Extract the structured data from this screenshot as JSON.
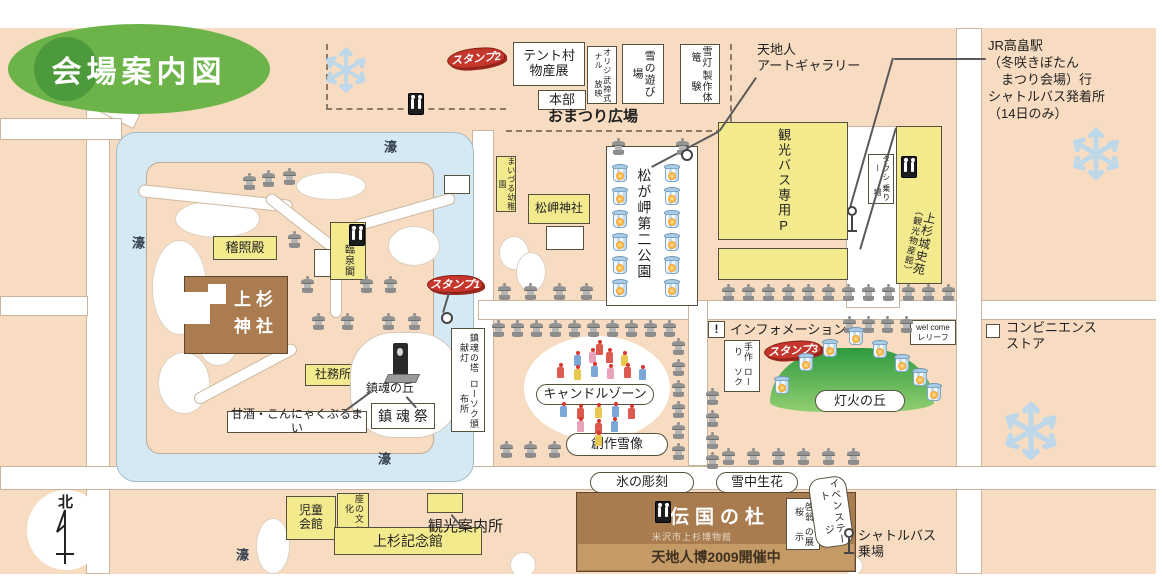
{
  "title": "会場案内図",
  "plaza": {
    "stamp2": "スタンプ2",
    "tent": [
      "テント村",
      "物産展"
    ],
    "honbu": "本部",
    "buteishiki": [
      "オリジナル",
      "武禘式放映"
    ],
    "snow_play": "雪の遊び場",
    "workshop": [
      "雪灯篭",
      "製作体験"
    ],
    "name": "おまつり広場"
  },
  "north_area": {
    "gallery": [
      "天地人",
      "アートギャラリー"
    ],
    "jr": [
      "JR高畠駅",
      "（冬咲きぼたん",
      "　まつり会場）行",
      "シャトルバス発着所",
      "（14日のみ）"
    ]
  },
  "east": {
    "bus_p": "観光バス専用P",
    "taxi": [
      "タクシー",
      "乗り場"
    ],
    "joshien": [
      "上杉城史苑",
      "（観光物産館）"
    ],
    "convenience": [
      "コンビニエンス",
      "ストア"
    ]
  },
  "park": {
    "kindergarten": "まいづる幼稚園",
    "shrine": "松岬神社",
    "name": "松が岬第二公園"
  },
  "island": {
    "keishoden": "稽照殿",
    "rinsenkaku": "臨泉閣",
    "uesugi": [
      "上杉",
      "神社"
    ],
    "shamusho": "社務所",
    "stamp1": "スタンプ1",
    "chinkon_hill": "鎮魂の丘",
    "chinkon_sai": "鎮 魂 祭",
    "amazake": "甘酒・こんにゃくぶるまい",
    "tower": [
      "鎮魂の塔 献灯",
      "ローソク頒布所"
    ]
  },
  "moat_label": "濠",
  "candle": {
    "zone": "キャンドルゾーン",
    "snow_art": "創作雪像"
  },
  "info": {
    "bang": "!",
    "label": "インフォメーション",
    "handmade": [
      "手作り",
      "ローソク"
    ],
    "stamp3": "スタンプ3",
    "hill": "灯火の丘",
    "welcome": [
      "wel come",
      "レリーフ"
    ]
  },
  "south": {
    "jido": [
      "児童",
      "会館"
    ],
    "za": [
      "座の文化",
      "伝承館"
    ],
    "kinenkan": "上杉記念館",
    "annai": "観光案内所",
    "ice": "氷の彫刻",
    "snow_flower": "雪中生花",
    "denkoku": "伝国の杜",
    "museum": "米沢市上杉博物館",
    "expo": "天地人博2009開催中",
    "sakura": [
      "啓翁桜",
      "の展示"
    ],
    "stage": [
      "イベント",
      "ステージ"
    ],
    "shuttle": [
      "シャトルバス",
      "乗場"
    ],
    "north": "北"
  },
  "colors": {
    "background": "#f7dcc2",
    "moat_blue": "#d5e9f5",
    "building_yellow": "#f3ea8e",
    "building_brown": "#ab7c50",
    "title_green": "#6cb44a",
    "stamp_red": "#c5362c",
    "hill_green": "#3f9f46",
    "snowflake_blue": "#b8d8ee"
  },
  "map_icons": {
    "stone_lanterns": [
      [
        243,
        173
      ],
      [
        262,
        170
      ],
      [
        283,
        168
      ],
      [
        288,
        231
      ],
      [
        301,
        276
      ],
      [
        360,
        276
      ],
      [
        384,
        276
      ],
      [
        312,
        313
      ],
      [
        341,
        313
      ],
      [
        382,
        313
      ],
      [
        408,
        313
      ],
      [
        612,
        138
      ],
      [
        676,
        138
      ],
      [
        498,
        283
      ],
      [
        524,
        283
      ],
      [
        553,
        283
      ],
      [
        580,
        283
      ],
      [
        722,
        284
      ],
      [
        742,
        284
      ],
      [
        762,
        284
      ],
      [
        782,
        284
      ],
      [
        802,
        284
      ],
      [
        822,
        284
      ],
      [
        842,
        284
      ],
      [
        862,
        284
      ],
      [
        882,
        284
      ],
      [
        902,
        284
      ],
      [
        922,
        284
      ],
      [
        942,
        284
      ],
      [
        492,
        320
      ],
      [
        511,
        320
      ],
      [
        530,
        320
      ],
      [
        549,
        320
      ],
      [
        568,
        320
      ],
      [
        587,
        320
      ],
      [
        606,
        320
      ],
      [
        625,
        320
      ],
      [
        644,
        320
      ],
      [
        663,
        320
      ],
      [
        672,
        338
      ],
      [
        672,
        359
      ],
      [
        672,
        380
      ],
      [
        672,
        401
      ],
      [
        672,
        422
      ],
      [
        672,
        443
      ],
      [
        500,
        441
      ],
      [
        524,
        441
      ],
      [
        548,
        441
      ],
      [
        706,
        388
      ],
      [
        706,
        410
      ],
      [
        706,
        432
      ],
      [
        706,
        452
      ],
      [
        843,
        316
      ],
      [
        862,
        316
      ],
      [
        881,
        316
      ],
      [
        900,
        316
      ],
      [
        722,
        448
      ],
      [
        747,
        448
      ],
      [
        772,
        448
      ],
      [
        797,
        448
      ],
      [
        822,
        448
      ],
      [
        847,
        448
      ]
    ],
    "snow_lanterns": [
      [
        612,
        164
      ],
      [
        612,
        187
      ],
      [
        612,
        210
      ],
      [
        612,
        233
      ],
      [
        612,
        256
      ],
      [
        612,
        279
      ],
      [
        664,
        164
      ],
      [
        664,
        187
      ],
      [
        664,
        210
      ],
      [
        664,
        233
      ],
      [
        664,
        256
      ],
      [
        664,
        279
      ],
      [
        774,
        376
      ],
      [
        798,
        353
      ],
      [
        822,
        339
      ],
      [
        848,
        327
      ],
      [
        872,
        340
      ],
      [
        894,
        354
      ],
      [
        912,
        368
      ],
      [
        926,
        383
      ]
    ],
    "candles": [
      [
        596,
        344,
        0
      ],
      [
        574,
        355,
        1
      ],
      [
        589,
        352,
        3
      ],
      [
        606,
        352,
        0
      ],
      [
        621,
        355,
        2
      ],
      [
        557,
        367,
        0
      ],
      [
        574,
        369,
        2
      ],
      [
        591,
        366,
        1
      ],
      [
        607,
        368,
        3
      ],
      [
        624,
        367,
        0
      ],
      [
        639,
        369,
        1
      ],
      [
        560,
        406,
        1
      ],
      [
        577,
        408,
        0
      ],
      [
        595,
        407,
        2
      ],
      [
        612,
        406,
        1
      ],
      [
        628,
        408,
        0
      ],
      [
        577,
        421,
        3
      ],
      [
        595,
        423,
        0
      ],
      [
        611,
        421,
        1
      ],
      [
        595,
        435,
        2
      ]
    ],
    "snowflakes": [
      [
        322,
        46,
        48
      ],
      [
        1068,
        126,
        56
      ],
      [
        1000,
        400,
        62
      ]
    ],
    "toilets": [
      [
        408,
        93
      ],
      [
        349,
        224
      ],
      [
        901,
        156
      ],
      [
        655,
        501
      ]
    ],
    "circles": [
      [
        441,
        312
      ],
      [
        681,
        149
      ]
    ],
    "posts": [
      [
        846,
        206
      ],
      [
        843,
        528
      ]
    ],
    "lines": [
      [
        757,
        78,
        720,
        132
      ],
      [
        720,
        132,
        652,
        168
      ],
      [
        894,
        58,
        986,
        58
      ],
      [
        894,
        58,
        851,
        208
      ],
      [
        450,
        293,
        444,
        313
      ],
      [
        452,
        514,
        463,
        527
      ],
      [
        371,
        393,
        344,
        413
      ],
      [
        407,
        396,
        417,
        407
      ],
      [
        897,
        128,
        861,
        250
      ]
    ]
  }
}
